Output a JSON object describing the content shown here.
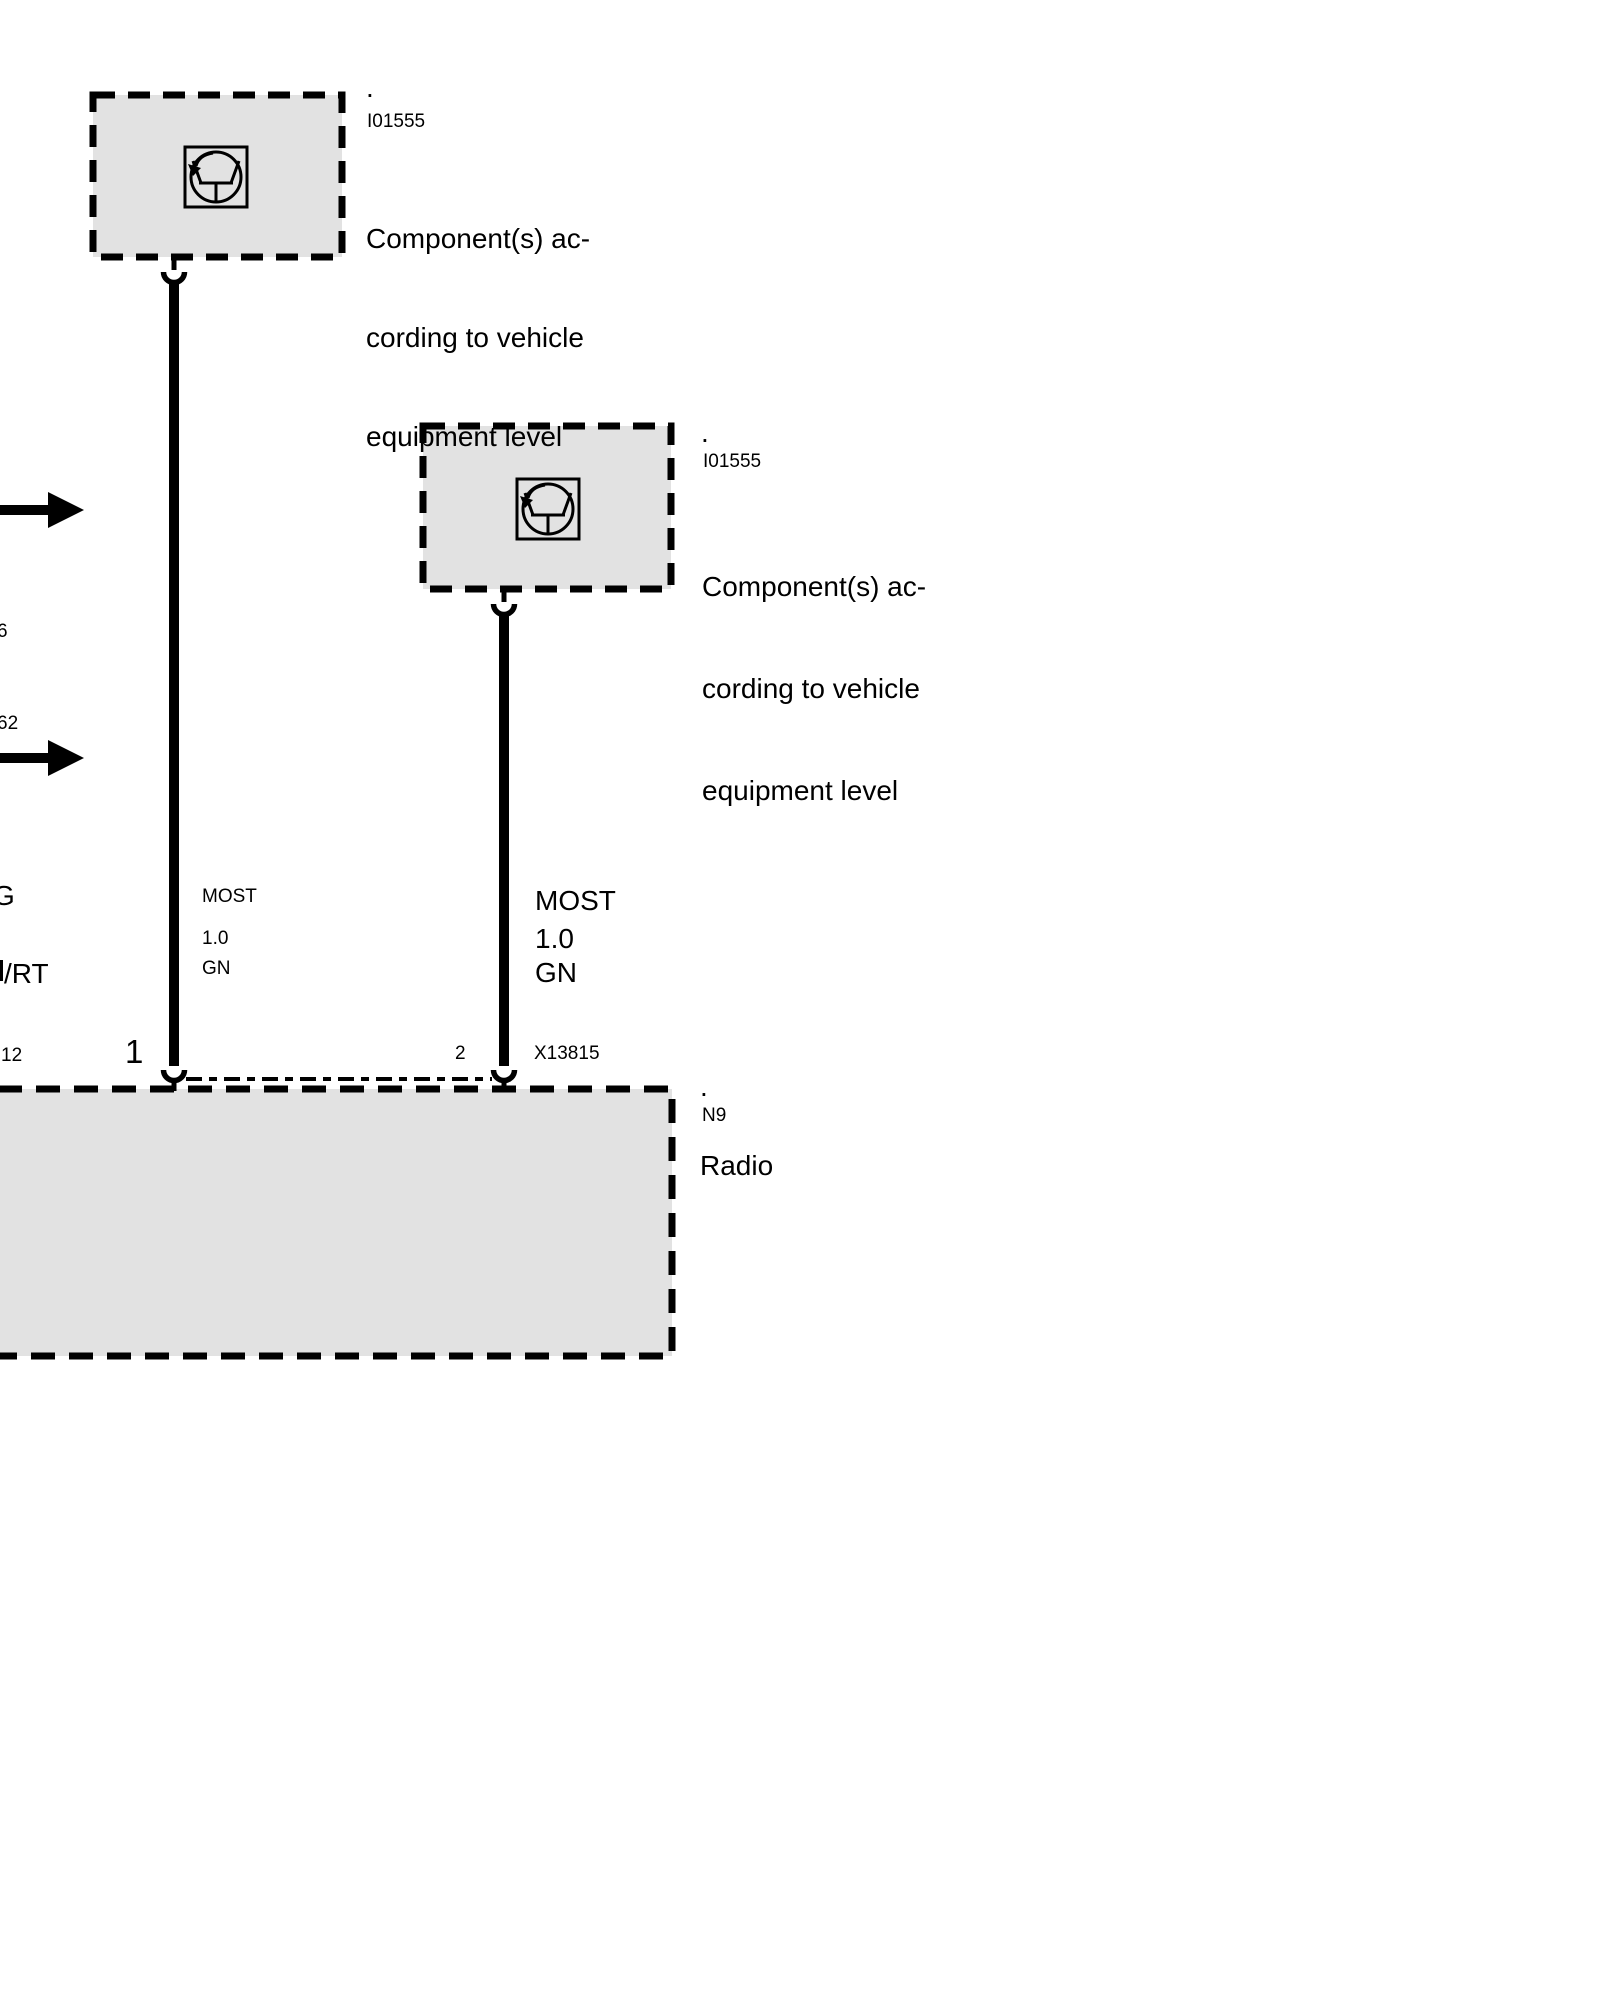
{
  "colors": {
    "background": "#ffffff",
    "box_fill": "#e2e2e2",
    "line": "#000000"
  },
  "boxes": {
    "component_top": {
      "dot": ".",
      "code": "I01555",
      "desc1": "Component(s) ac-",
      "desc2": "cording to vehicle",
      "desc3": "equipment level"
    },
    "component_mid": {
      "dot": ".",
      "code": "I01555",
      "desc1": "Component(s) ac-",
      "desc2": "cording to vehicle",
      "desc3": "equipment level"
    },
    "radio": {
      "dot": ".",
      "code": "N9",
      "name": "Radio"
    }
  },
  "wires": {
    "wire1": {
      "bus": "MOST",
      "cross_section": "1.0",
      "color_code": "GN",
      "pin": "1"
    },
    "wire2": {
      "bus": "MOST",
      "cross_section": "1.0",
      "color_code": "GN",
      "pin": "2",
      "connector": "X13815"
    }
  },
  "edge_labels": {
    "fragment_top": "6",
    "fragment_middle": "62",
    "wire_name_fragment": "G",
    "wire_color_fragment": "/RT",
    "pin_fragment": "12"
  }
}
